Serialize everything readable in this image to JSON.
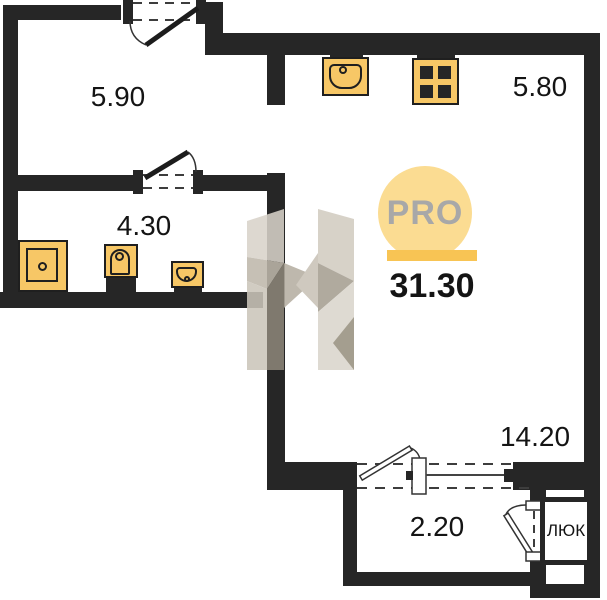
{
  "title": "apartment floor plan",
  "logo": {
    "text": "PRO"
  },
  "total_area": "31.30",
  "rooms": {
    "hallway": "5.90",
    "bathroom": "4.30",
    "kitchen": "5.80",
    "living": "14.20",
    "balcony": "2.20"
  },
  "hatch_label": "ЛЮК",
  "colors": {
    "wall": "#262626",
    "fixture_fill": "#F7C766",
    "fixture_stroke": "#1f1f1f",
    "logo_circle": "#FBDC92",
    "logo_bar": "#F8C454",
    "logo_text": "#A8A8A8",
    "label_text": "#141414"
  }
}
